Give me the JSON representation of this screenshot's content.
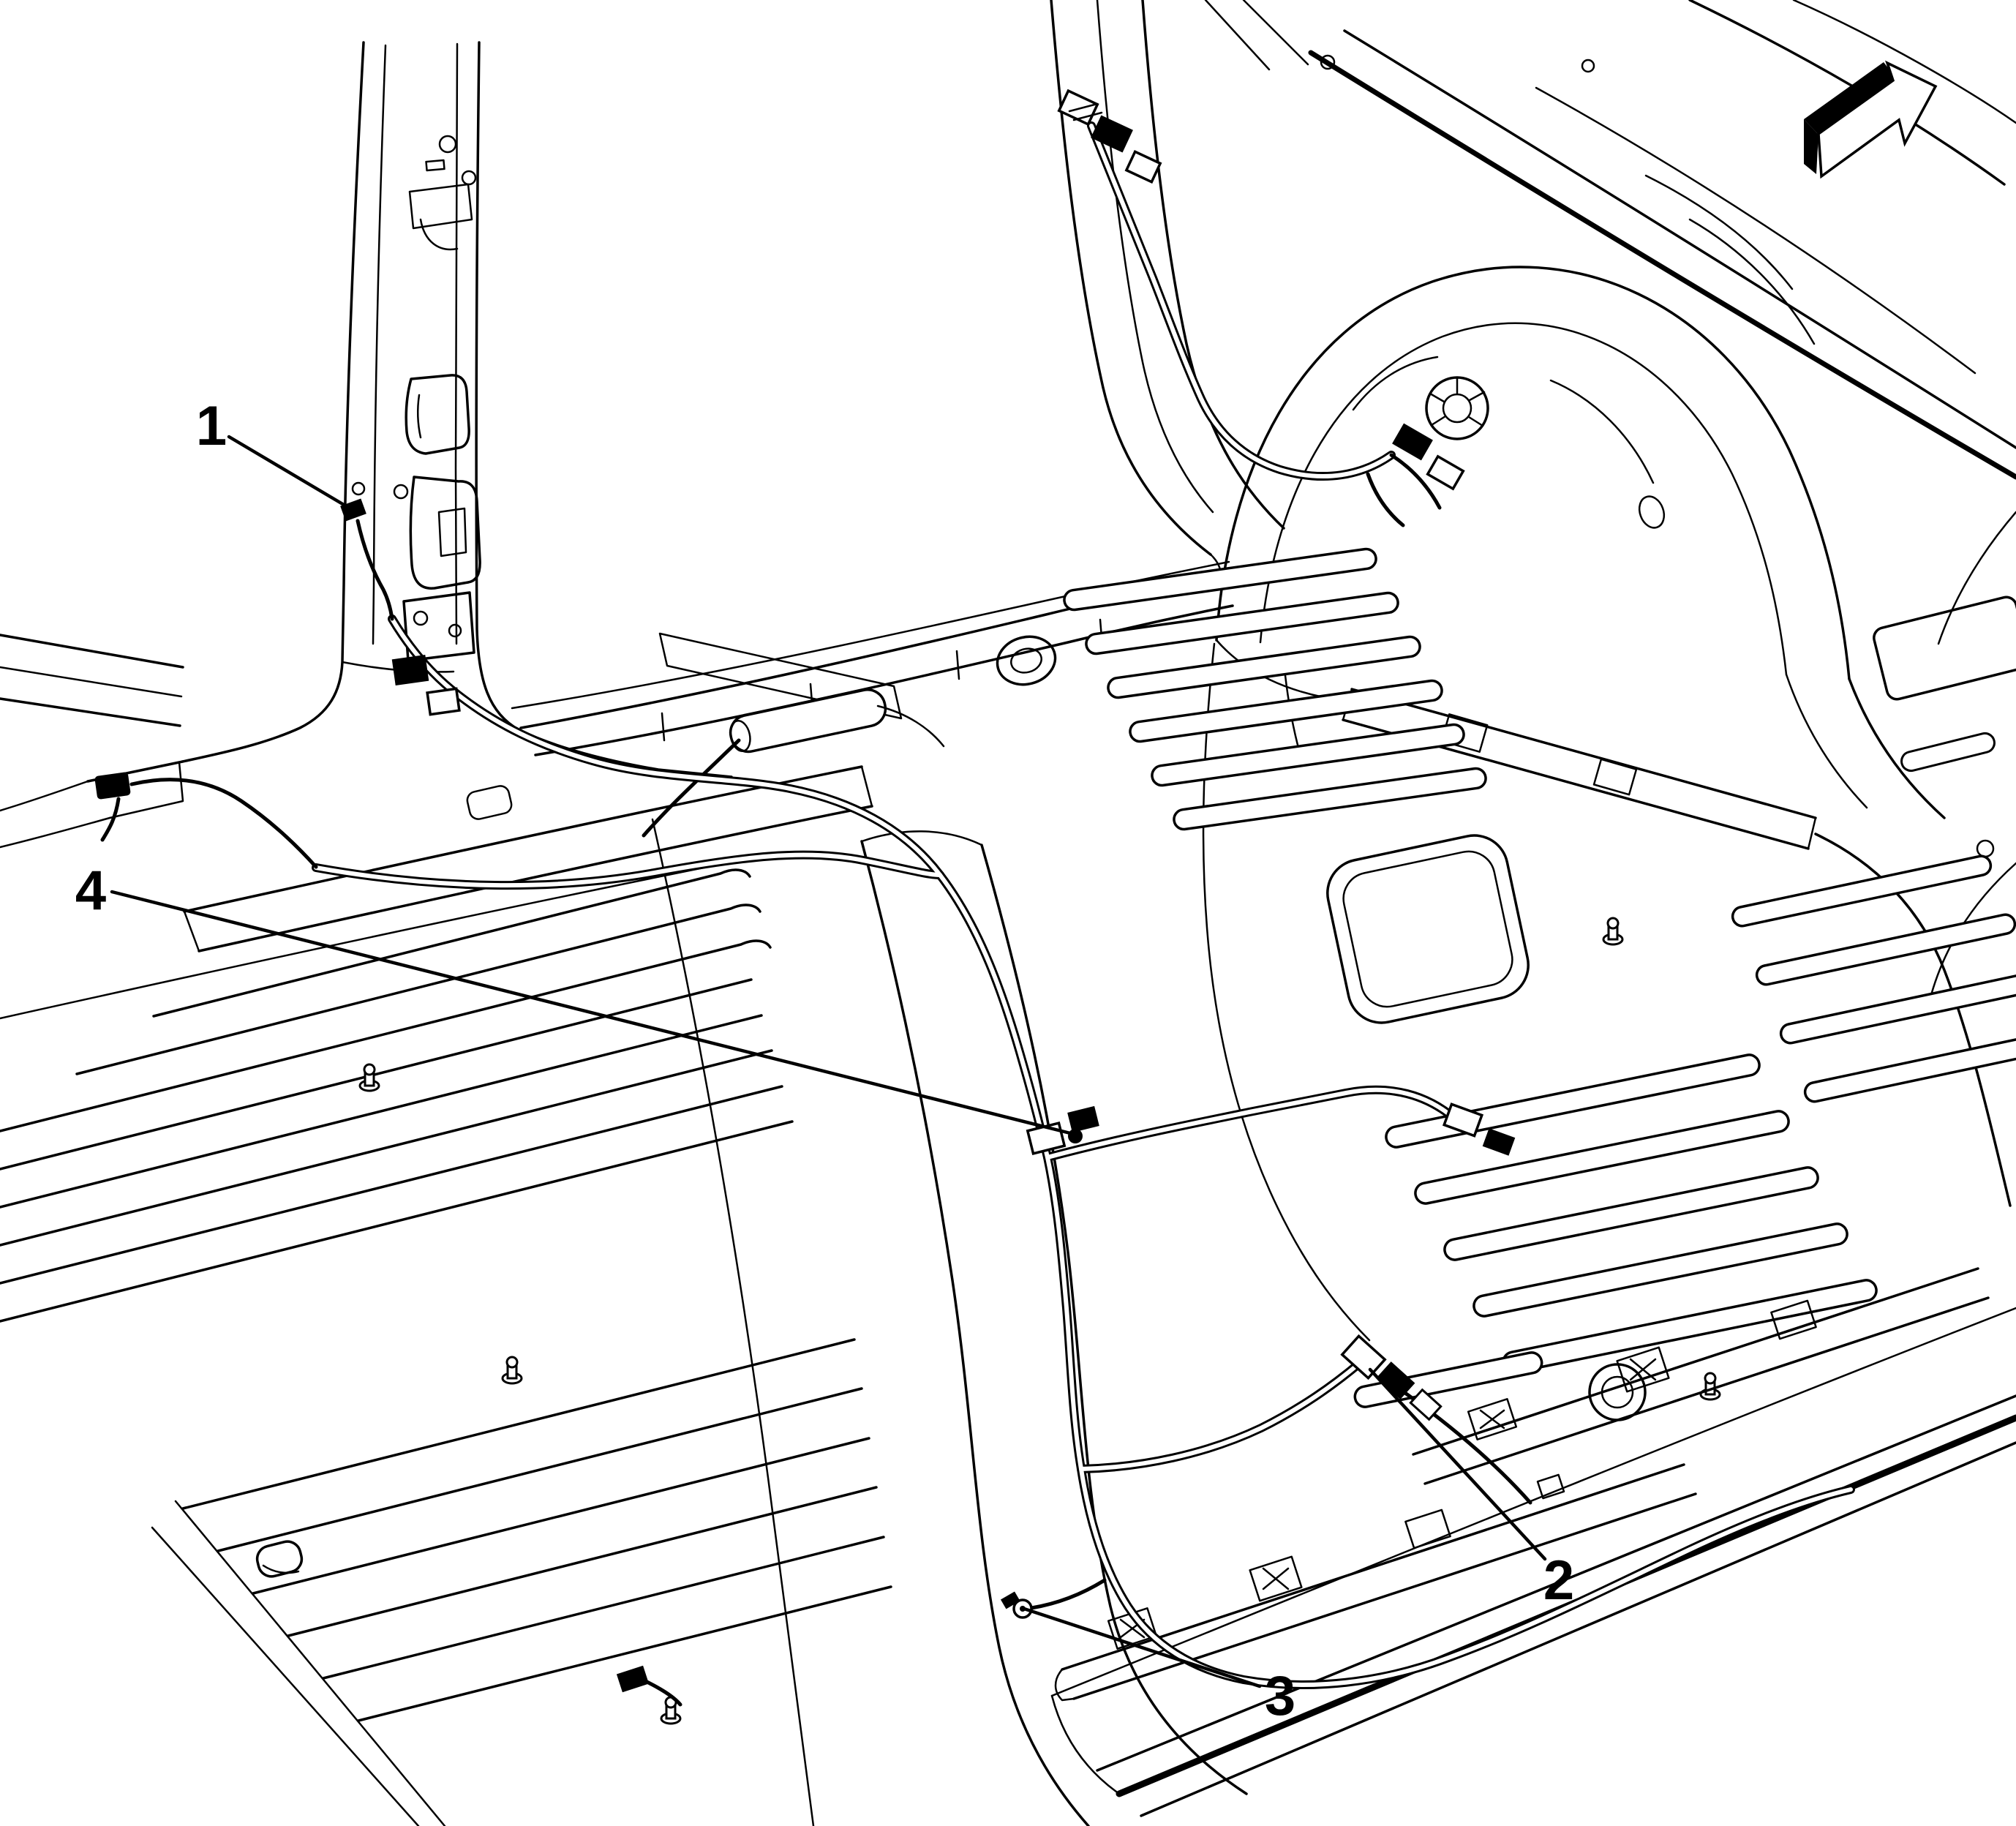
{
  "figure": {
    "description": "Isometric black-and-white service-manual line illustration of a vehicle body interior floor pan showing wiring harness routing with numbered component callouts",
    "background_color": "#ffffff",
    "line_color": "#000000",
    "callouts": [
      {
        "label": "1"
      },
      {
        "label": "2"
      },
      {
        "label": "3"
      },
      {
        "label": "4"
      }
    ],
    "direction_arrow_icon": "front-of-vehicle-arrow-icon"
  }
}
